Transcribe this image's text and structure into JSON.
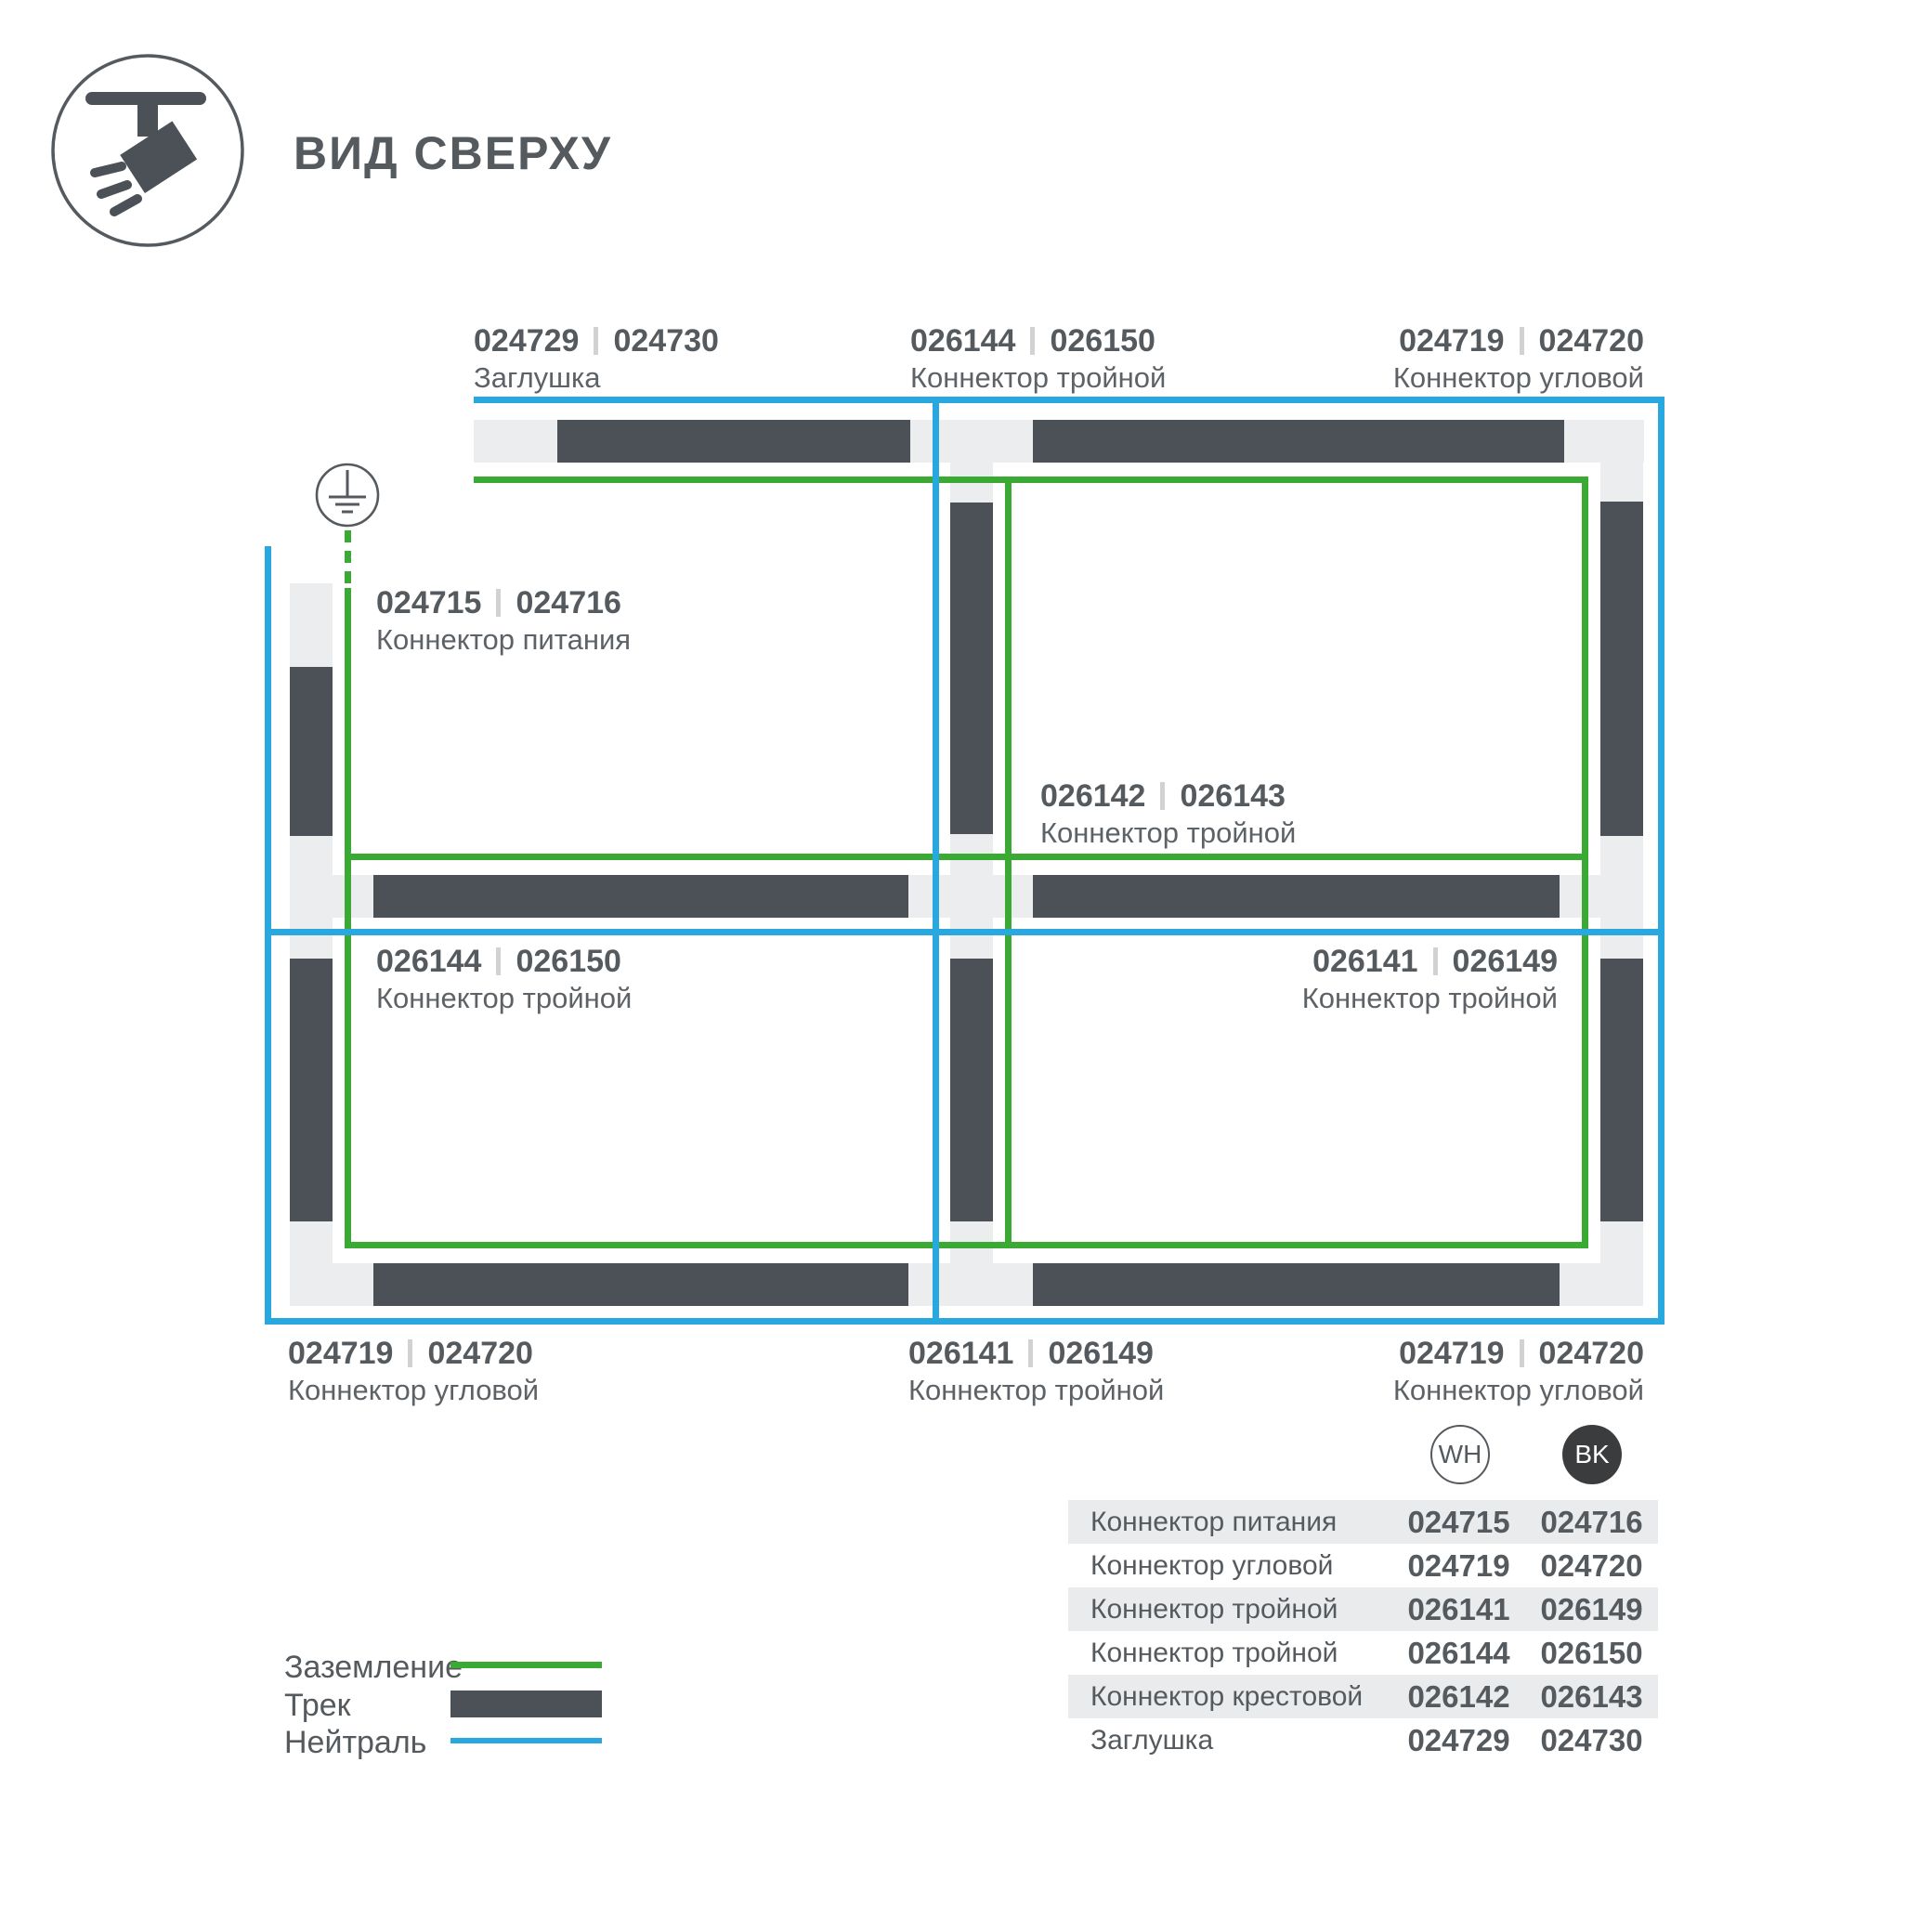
{
  "header": {
    "title": "ВИД СВЕРХУ"
  },
  "diagram": {
    "labels": [
      {
        "code_a": "024729",
        "code_b": "024730",
        "name": "Заглушка"
      },
      {
        "code_a": "026144",
        "code_b": "026150",
        "name": "Коннектор тройной"
      },
      {
        "code_a": "024719",
        "code_b": "024720",
        "name": "Коннектор угловой"
      },
      {
        "code_a": "024715",
        "code_b": "024716",
        "name": "Коннектор питания"
      },
      {
        "code_a": "026142",
        "code_b": "026143",
        "name": "Коннектор тройной"
      },
      {
        "code_a": "026144",
        "code_b": "026150",
        "name": "Коннектор тройной"
      },
      {
        "code_a": "026141",
        "code_b": "026149",
        "name": "Коннектор тройной"
      },
      {
        "code_a": "024719",
        "code_b": "024720",
        "name": "Коннектор угловой"
      },
      {
        "code_a": "026141",
        "code_b": "026149",
        "name": "Коннектор тройной"
      },
      {
        "code_a": "024719",
        "code_b": "024720",
        "name": "Коннектор угловой"
      }
    ]
  },
  "legend": {
    "ground_label": "Заземление",
    "track_label": "Трек",
    "neutral_label": "Нейтраль"
  },
  "table": {
    "col_wh": "WH",
    "col_bk": "BK",
    "rows": [
      {
        "name": "Коннектор питания",
        "wh": "024715",
        "bk": "024716"
      },
      {
        "name": "Коннектор угловой",
        "wh": "024719",
        "bk": "024720"
      },
      {
        "name": "Коннектор тройной",
        "wh": "026141",
        "bk": "026149"
      },
      {
        "name": "Коннектор тройной",
        "wh": "026144",
        "bk": "026150"
      },
      {
        "name": "Коннектор крестовой",
        "wh": "026142",
        "bk": "026143"
      },
      {
        "name": "Заглушка",
        "wh": "024729",
        "bk": "024730"
      }
    ]
  },
  "colors": {
    "track": "#4b5157",
    "connector": "#ebedee",
    "ground_green": "#3aaa35",
    "neutral_blue": "#29a8e0",
    "text": "#555a5f",
    "table_row": "#e9ebec",
    "bk_badge": "#3a3c3e"
  }
}
